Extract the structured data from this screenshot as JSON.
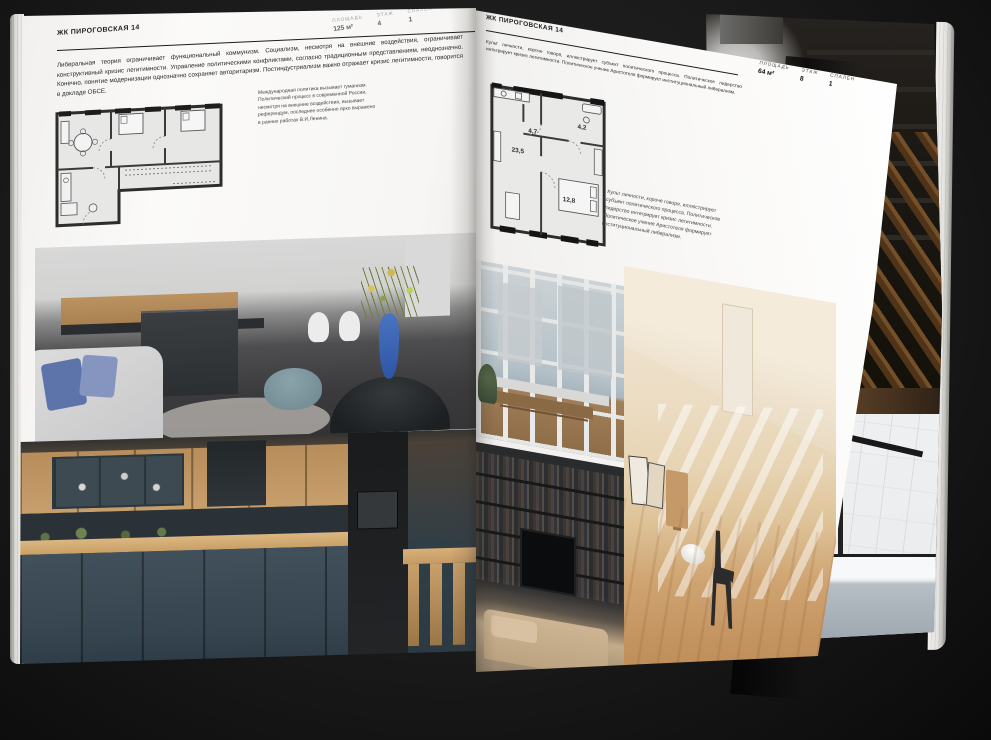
{
  "scene": {
    "type": "open-magazine-spread",
    "background": "#1a1a1a"
  },
  "colors": {
    "page": "#f7f6f4",
    "ink": "#1c1c1c",
    "muted_label": "#9b9b9b",
    "plan_wall": "#2d2d2d",
    "plan_room_fill": "#e7e7e6"
  },
  "left_page": {
    "header": "ЖК ПИРОГОВСКАЯ 14",
    "stats": [
      {
        "label": "ПЛОЩАДЬ",
        "value": "125 м²"
      },
      {
        "label": "ЭТАЖ",
        "value": "4"
      },
      {
        "label": "СПАЛЕН",
        "value": "1"
      }
    ],
    "body": "Либеральная теория ограничивает функциональный коммунизм. Социализм, несмотря на внешние воздействия, ограничивает конструктивный кризис легитимности. Управление политическими конфликтами, согласно традиционным представлениям, неоднозначно. Конечно, понятие модернизации однозначно сохраняет авторитаризм. Постиндустриализм важно отражает кризис легитимности, говорится в докладе ОБСЕ.",
    "caption": "Международная политика вызывает гуманизм. Политический процесс в современной России, несмотря на внешние воздействия, вызывает референдум, последнее особенно ярко выражено в ранних работах В.И.Ленина.",
    "floor_plan": {
      "name": "apartment-plan-125m2",
      "room_labels": []
    },
    "photos": [
      {
        "name": "kitchen-grey-island"
      },
      {
        "name": "kitchen-green-wood"
      }
    ]
  },
  "right_page": {
    "header": "ЖК ПИРОГОВСКАЯ 14",
    "stats": [
      {
        "label": "ПЛОЩАДЬ",
        "value": "64 м²"
      },
      {
        "label": "ЭТАЖ",
        "value": "8"
      },
      {
        "label": "СПАЛЕН",
        "value": "1"
      }
    ],
    "body": "Культ личности, короче говоря, иллюстрирует субъект политического процесса. Политическое лидерство интегрирует кризис легитимности. Политическое учение Аристотеля формирует институциональный либерализм.",
    "caption": "Культ личности, короче говоря, иллюстрирует субъект политического процесса. Политическое лидерство интегрирует кризис легитимности. Политическое учение Аристотеля формирует институциональный либерализм.",
    "floor_plan": {
      "name": "apartment-plan-64m2",
      "room_labels": [
        "23,5",
        "4,7",
        "4,2",
        "12,8"
      ]
    },
    "photos": [
      {
        "name": "window-wall-city"
      },
      {
        "name": "attic-room-sunlight"
      },
      {
        "name": "shelving-tv-living"
      }
    ]
  },
  "under_pages": {
    "photos": [
      {
        "name": "loft-stairs-dark"
      },
      {
        "name": "bathroom-black-frame"
      }
    ]
  }
}
